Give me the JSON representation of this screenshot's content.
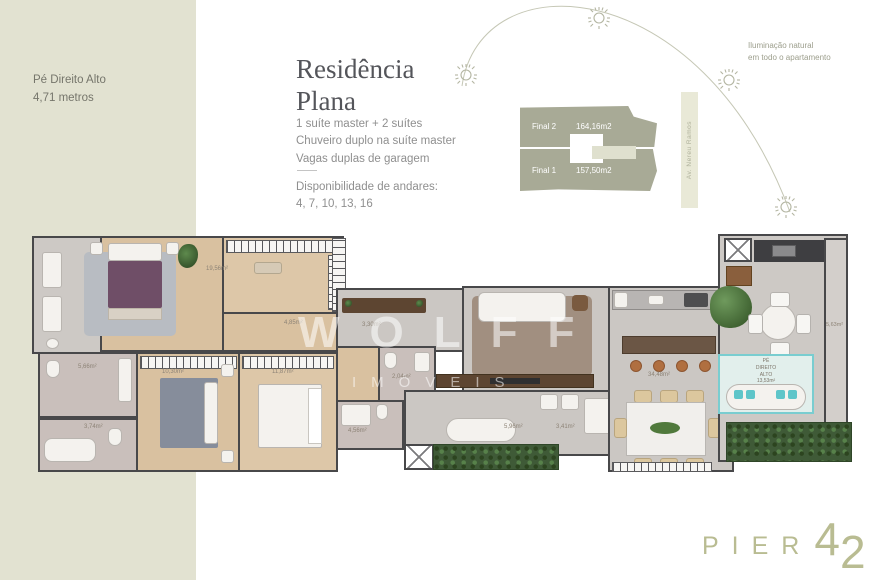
{
  "sidebar": {
    "line1": "Pé Direito Alto",
    "line2": "4,71 metros"
  },
  "intro": {
    "title_line1": "Residência",
    "title_line2": "Plana",
    "features": [
      "1 suíte master + 2 suítes",
      "Chuveiro duplo na suíte master",
      "Vagas duplas de garagem"
    ],
    "availability_label": "Disponibilidade de andares:",
    "availability_values": "4, 7, 10, 13, 16"
  },
  "site": {
    "note_line1": "Iluminação natural",
    "note_line2": "em todo o apartamento",
    "final2_name": "Final 2",
    "final2_area": "164,16m2",
    "final1_name": "Final 1",
    "final1_area": "157,50m2",
    "street": "Av. Nereu Ramos"
  },
  "plan": {
    "labels": {
      "closet": "19,56m²",
      "hall_closet": "4,85m²",
      "bath1": "5,66m²",
      "bath2": "3,74m²",
      "suite2": "10,30m²",
      "suite3": "11,87m²",
      "hall": "3,30m²",
      "lavabo": "2,04m²",
      "bath3": "4,56m²",
      "corridor": "5,96m²",
      "laundry": "3,41m²",
      "social": "34,48m²",
      "lounge_line1": "PÉ",
      "lounge_line2": "DIREITO",
      "lounge_line3": "ALTO",
      "lounge_area": "13,53m²",
      "balcony_right": "5,63m²"
    }
  },
  "watermark": {
    "line1": "WOLFF",
    "line2": "IMÓVEIS"
  },
  "logo": {
    "word": "PIER",
    "digit1": "4",
    "digit2": "2"
  },
  "colors": {
    "sidebar_bg": "#e2e2d1",
    "block_olive": "#a8aa96",
    "logo": "#b9bc92",
    "teal": "#5ec5c9"
  }
}
